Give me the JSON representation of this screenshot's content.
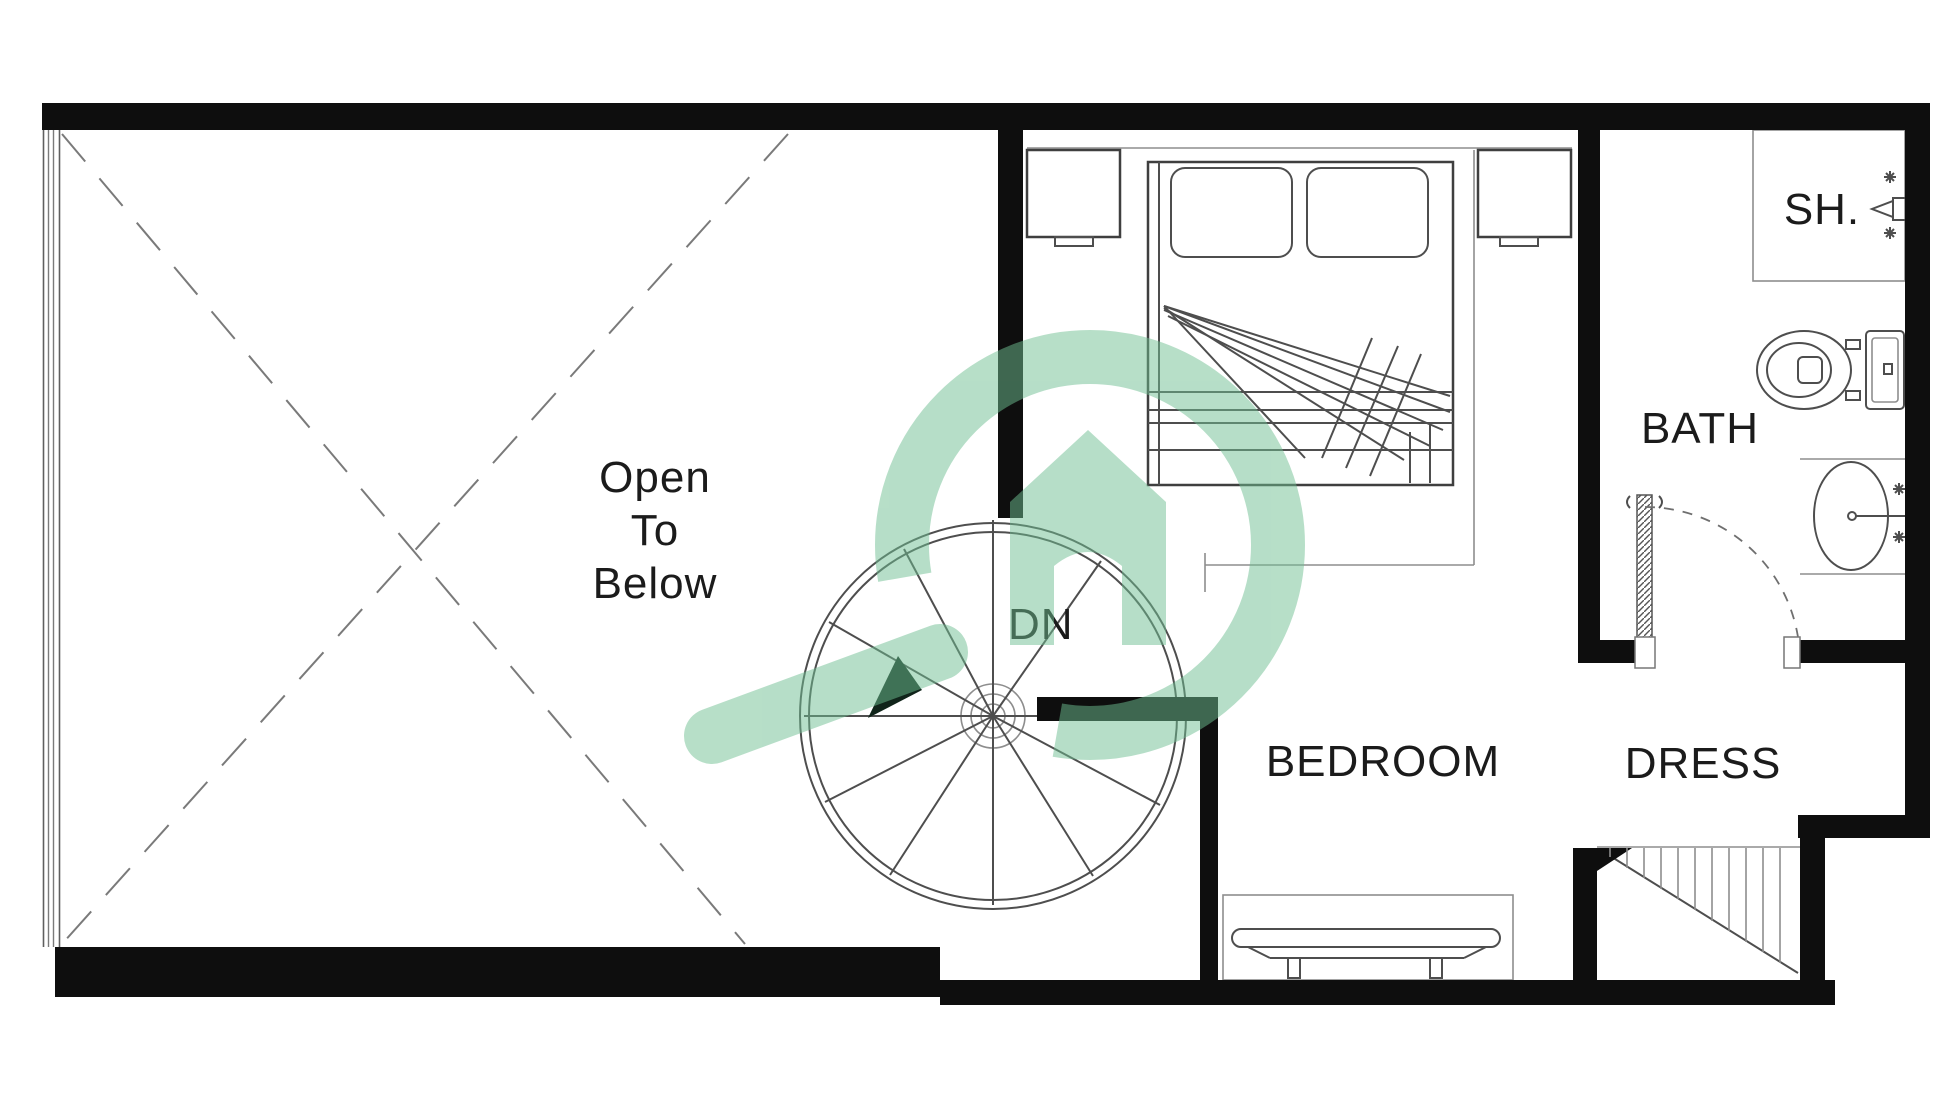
{
  "document": {
    "kind": "architectural-floor-plan",
    "view": "upper-level plan with open void, spiral stair, bedroom, bath and dressing area"
  },
  "labels": {
    "open_line1": "Open",
    "open_line2": "To",
    "open_line3": "Below",
    "down": "DN",
    "bedroom": "BEDROOM",
    "bath": "BATH",
    "dress": "DRESS",
    "shower": "SH."
  },
  "fixtures": {
    "spiral_staircase": "spiral-staircase-icon",
    "direction_arrow": "stair-direction-arrow-icon",
    "bed": "double-bed-icon",
    "nightstands": "nightstand-icon",
    "dresser_bench": "dresser-bench-icon",
    "shower_head": "shower-head-icon",
    "toilet": "toilet-icon",
    "sink": "sink-icon",
    "bath_door": "swing-door-icon",
    "dress_stairs": "straight-stair-icon",
    "void_cross": "open-void-cross-lines"
  },
  "watermark": {
    "icon": "house-in-circle-logo",
    "color": "#6fbf92"
  },
  "colors": {
    "wall": "#0e0e0e",
    "line_dark": "#4e4e4e",
    "line_light": "#8d8d8d",
    "text": "#1b1b1b",
    "background": "#ffffff",
    "watermark_green": "#6fbf92"
  }
}
